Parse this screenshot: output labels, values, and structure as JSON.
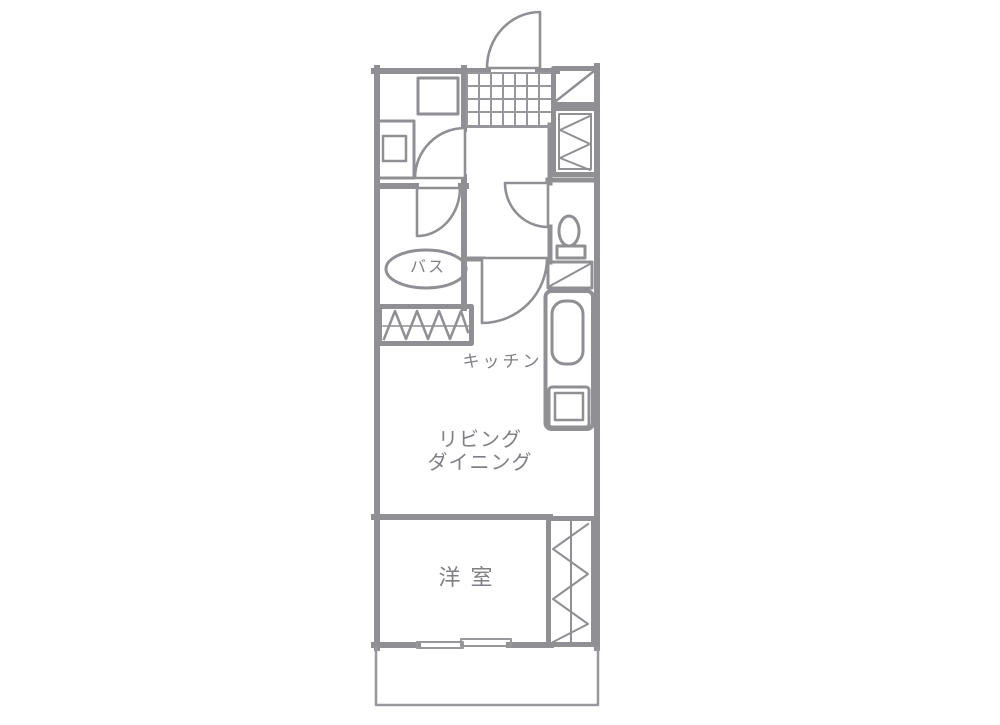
{
  "plan": {
    "type": "apartment-floor-plan",
    "rooms": {
      "bath": {
        "label": "バス"
      },
      "kitchen": {
        "label": "キッチン"
      },
      "living_dining": {
        "label_line1": "リビング",
        "label_line2": "ダイニング"
      },
      "western_room": {
        "label": "洋室"
      }
    },
    "colors": {
      "wall_line": "#8f8f94",
      "thin_line": "#97979c",
      "label_text": "#7f7f86",
      "background": "#ffffff"
    }
  }
}
